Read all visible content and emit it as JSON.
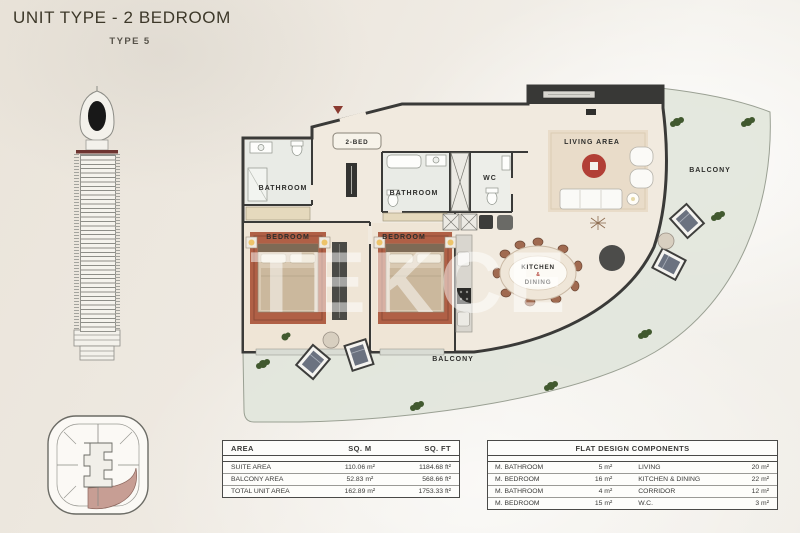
{
  "header": {
    "title": "UNIT TYPE - 2 BEDROOM",
    "subtitle": "TYPE 5"
  },
  "watermark": "TEKCE",
  "plan": {
    "unit_badge": "2-BED",
    "rooms": {
      "bathroom1": "BATHROOM",
      "bathroom2": "BATHROOM",
      "wc": "WC",
      "bedroom1": "BEDROOM",
      "bedroom2": "BEDROOM",
      "living": "LIVING AREA",
      "kitchen_line1": "KITCHEN",
      "kitchen_amp": "&",
      "kitchen_line2": "DINING",
      "balcony_right": "BALCONY",
      "balcony_bottom": "BALCONY"
    }
  },
  "area_table": {
    "headers": [
      "AREA",
      "SQ. M",
      "SQ. FT"
    ],
    "rows": [
      {
        "name": "SUITE AREA",
        "sqm": "110.06 m²",
        "sqft": "1184.68 ft²"
      },
      {
        "name": "BALCONY AREA",
        "sqm": "52.83 m²",
        "sqft": "568.66 ft²"
      },
      {
        "name": "TOTAL UNIT AREA",
        "sqm": "162.89 m²",
        "sqft": "1753.33 ft²"
      }
    ]
  },
  "components_table": {
    "title": "FLAT DESIGN COMPONENTS",
    "rows": [
      {
        "c1": "M. BATHROOM",
        "v1": "5 m²",
        "c2": "LIVING",
        "v2": "20 m²"
      },
      {
        "c1": "M. BEDROOM",
        "v1": "16 m²",
        "c2": "KITCHEN & DINING",
        "v2": "22 m²"
      },
      {
        "c1": "M. BATHROOM",
        "v1": "4 m²",
        "c2": "CORRIDOR",
        "v2": "12 m²"
      },
      {
        "c1": "M. BEDROOM",
        "v1": "15 m²",
        "c2": "W.C.",
        "v2": "3 m²"
      }
    ]
  },
  "colors": {
    "wall": "#3a3a38",
    "floor": "#f1eadf",
    "balcony": "#e3e6de",
    "keyplan_highlight": "#c79e94",
    "level_band": "#6e3430",
    "rug_red": "#b23f36",
    "bed_carpet": "#b06046"
  }
}
